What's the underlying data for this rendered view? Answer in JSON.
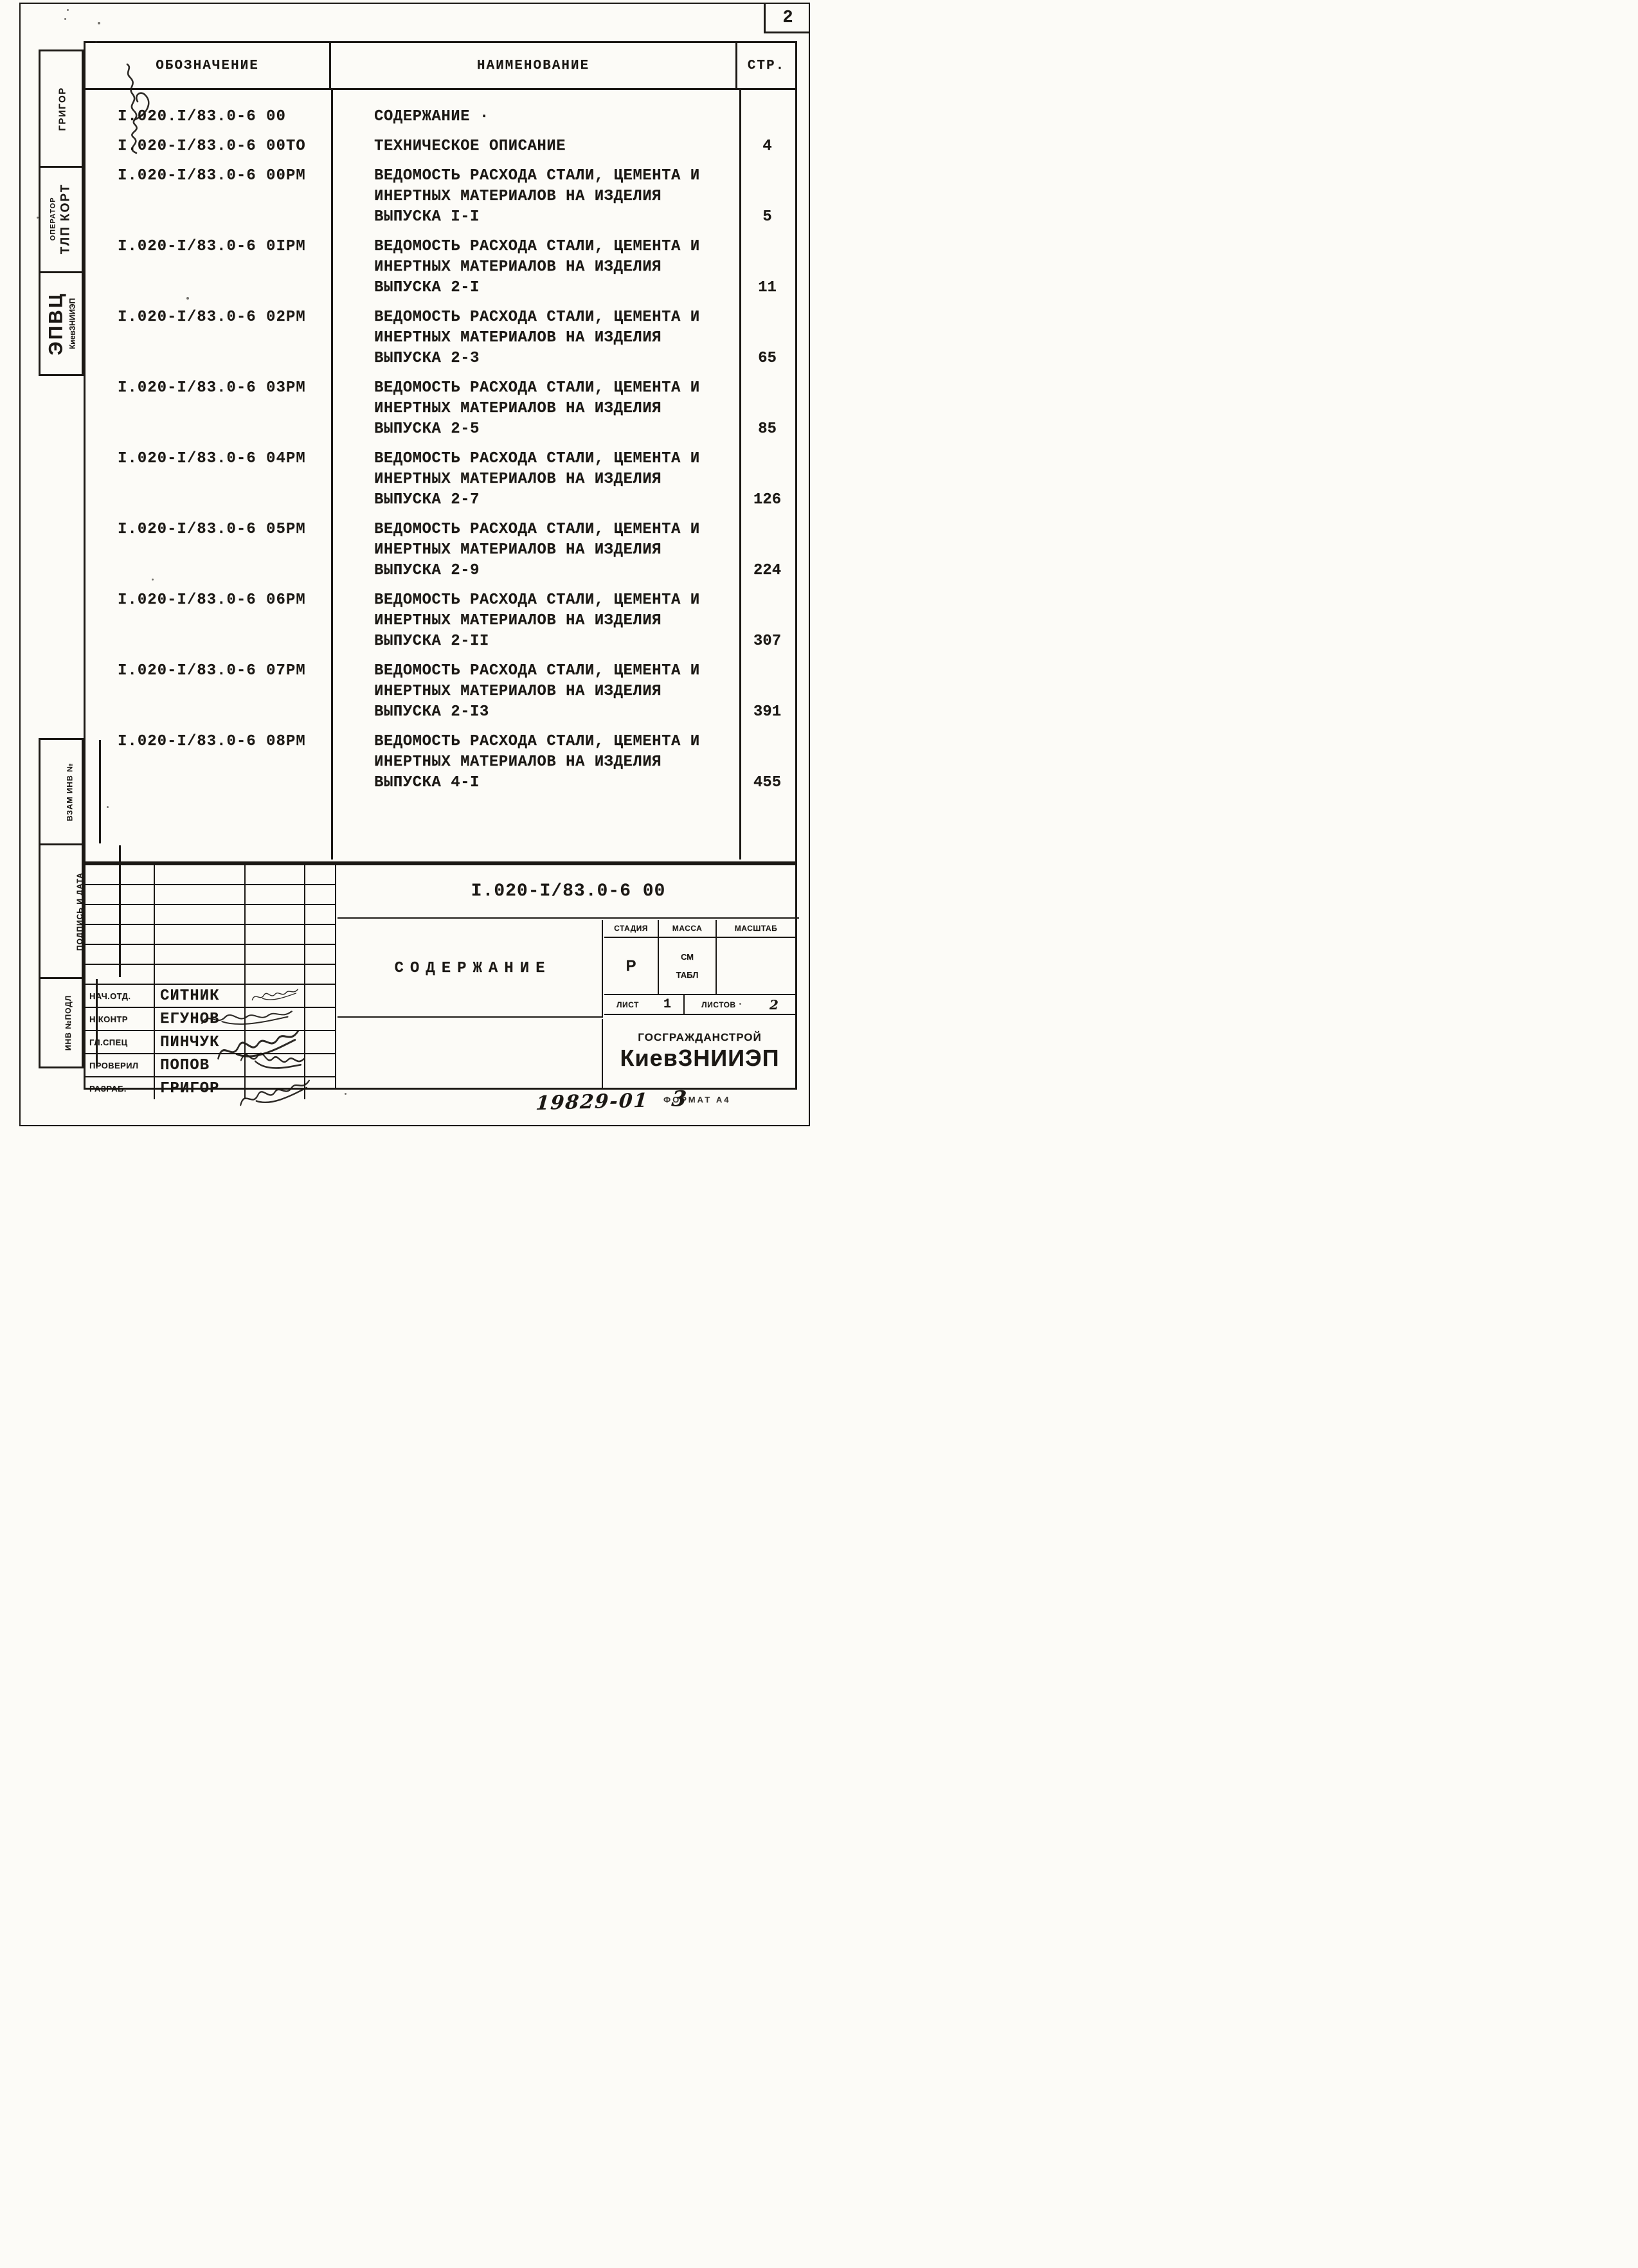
{
  "sheet": {
    "number": "2",
    "footer_doc_code": "19829-01",
    "footer_sheet": "3",
    "footer_format": "ФОРМАТ А4"
  },
  "toc": {
    "header": {
      "designation": "ОБОЗНАЧЕНИЕ",
      "name": "НАИМЕНОВАНИЕ",
      "page": "СТР."
    },
    "entries": [
      {
        "designation": "I.020.I/83.0-6 00",
        "name": "СОДЕРЖАНИЕ ·",
        "page": ""
      },
      {
        "designation": "I.020-I/83.0-6 00ТО",
        "name": "ТЕХНИЧЕСКОЕ ОПИСАНИЕ",
        "page": "4"
      },
      {
        "designation": "I.020-I/83.0-6 00РМ",
        "name": "ВЕДОМОСТЬ РАСХОДА СТАЛИ, ЦЕМЕНТА И\nИНЕРТНЫХ МАТЕРИАЛОВ НА ИЗДЕЛИЯ\nВЫПУСКА I-I",
        "page": "5"
      },
      {
        "designation": "I.020-I/83.0-6 0IРМ",
        "name": "ВЕДОМОСТЬ РАСХОДА СТАЛИ, ЦЕМЕНТА И\nИНЕРТНЫХ МАТЕРИАЛОВ НА ИЗДЕЛИЯ\nВЫПУСКА 2-I",
        "page": "11"
      },
      {
        "designation": "I.020-I/83.0-6 02РМ",
        "name": "ВЕДОМОСТЬ РАСХОДА СТАЛИ, ЦЕМЕНТА И\nИНЕРТНЫХ МАТЕРИАЛОВ НА ИЗДЕЛИЯ\nВЫПУСКА 2-3",
        "page": "65"
      },
      {
        "designation": "I.020-I/83.0-6 03РМ",
        "name": "ВЕДОМОСТЬ РАСХОДА СТАЛИ, ЦЕМЕНТА И\nИНЕРТНЫХ МАТЕРИАЛОВ НА ИЗДЕЛИЯ\nВЫПУСКА 2-5",
        "page": "85"
      },
      {
        "designation": "I.020-I/83.0-6 04РМ",
        "name": "ВЕДОМОСТЬ РАСХОДА СТАЛИ, ЦЕМЕНТА И\nИНЕРТНЫХ МАТЕРИАЛОВ НА ИЗДЕЛИЯ\nВЫПУСКА 2-7",
        "page": "126"
      },
      {
        "designation": "I.020-I/83.0-6 05РМ",
        "name": "ВЕДОМОСТЬ РАСХОДА СТАЛИ, ЦЕМЕНТА И\nИНЕРТНЫХ МАТЕРИАЛОВ НА ИЗДЕЛИЯ\nВЫПУСКА 2-9",
        "page": "224"
      },
      {
        "designation": "I.020-I/83.0-6 06РМ",
        "name": "ВЕДОМОСТЬ РАСХОДА СТАЛИ, ЦЕМЕНТА И\nИНЕРТНЫХ МАТЕРИАЛОВ НА ИЗДЕЛИЯ\nВЫПУСКА 2-II",
        "page": "307"
      },
      {
        "designation": "I.020-I/83.0-6 07РМ",
        "name": "ВЕДОМОСТЬ РАСХОДА СТАЛИ, ЦЕМЕНТА И\nИНЕРТНЫХ МАТЕРИАЛОВ НА ИЗДЕЛИЯ\nВЫПУСКА 2-I3",
        "page": "391"
      },
      {
        "designation": "I.020-I/83.0-6 08РМ",
        "name": "ВЕДОМОСТЬ РАСХОДА СТАЛИ, ЦЕМЕНТА И\nИНЕРТНЫХ МАТЕРИАЛОВ НА ИЗДЕЛИЯ\nВЫПУСКА 4-I",
        "page": "455"
      }
    ]
  },
  "sidebar": {
    "executor": "ГРИГОР",
    "operator_label": "ОПЕРАТОР",
    "operator_value": "ТЛП КОРТ",
    "org_abbr": "ЭПВЦ",
    "org_name": "КиевЗНИИЭП",
    "stamp_vzam": "ВЗАМ ИНВ №",
    "stamp_podpis": "ПОДПИСЬ И ДАТА",
    "stamp_inv": "ИНВ №ПОДЛ"
  },
  "title_block": {
    "document_number": "I.020-I/83.0-6 00",
    "title": "СОДЕРЖАНИЕ",
    "stage_label": "СТАДИЯ",
    "stage_value": "Р",
    "mass_label": "МАССА",
    "mass_value": "СМ\nТАБЛ",
    "scale_label": "МАСШТАБ",
    "sheet_label": "ЛИСТ",
    "sheet_value": "1",
    "sheets_label": "ЛИСТОВ",
    "sheets_value": "2",
    "org_top": "ГОСГРАЖДАНСТРОЙ",
    "org_main": "КиевЗНИИЭП",
    "signers": [
      {
        "role": "НАЧ.ОТД.",
        "name": "СИТНИК"
      },
      {
        "role": "Н.КОНТР",
        "name": "ЕГУНОВ"
      },
      {
        "role": "ГЛ.СПЕЦ",
        "name": "ПИНЧУК"
      },
      {
        "role": "ПРОВЕРИЛ",
        "name": "ПОПОВ"
      },
      {
        "role": "РАЗРАБ.",
        "name": "ГРИГОР"
      }
    ]
  }
}
